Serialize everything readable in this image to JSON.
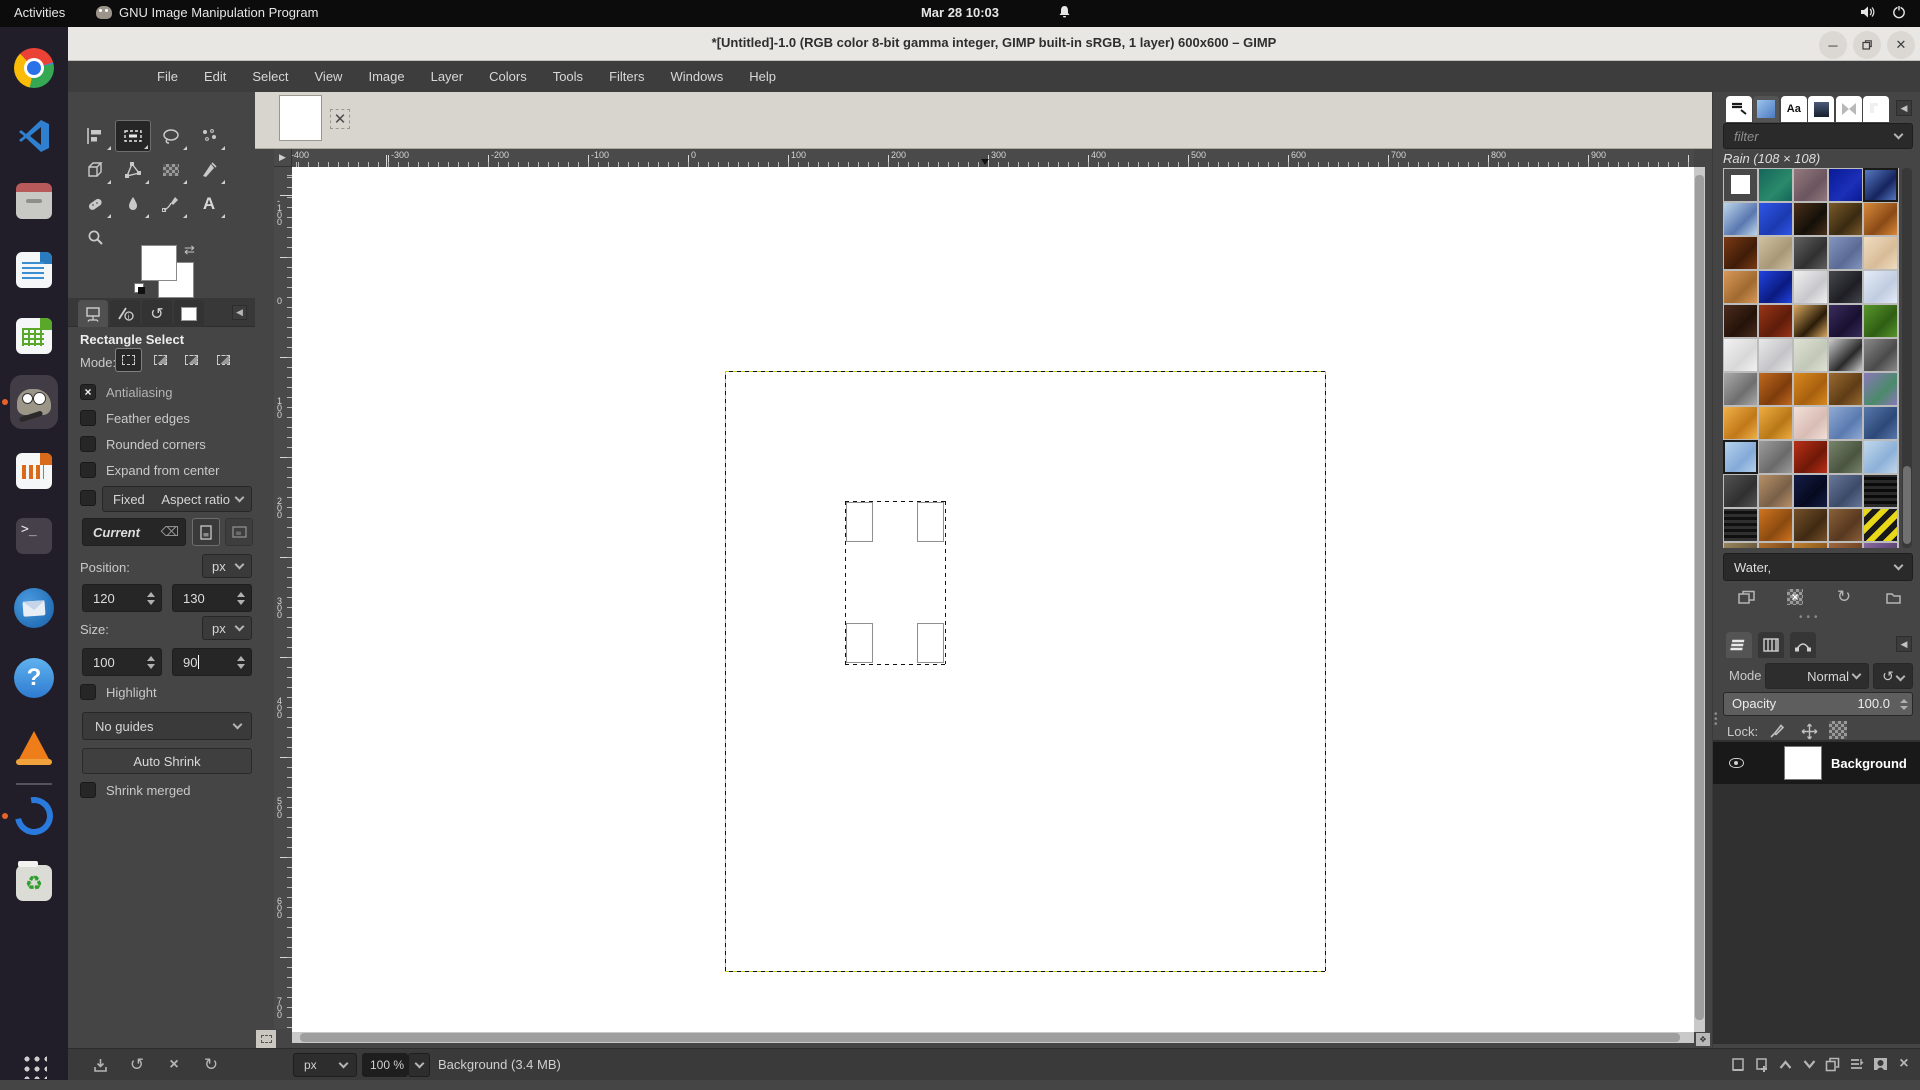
{
  "system_bar": {
    "activities": "Activities",
    "app_name": "GNU Image Manipulation Program",
    "clock": "Mar 28 10:03",
    "icons": [
      "bell-icon",
      "volume-icon",
      "power-icon"
    ]
  },
  "dock": {
    "items": [
      {
        "name": "chrome"
      },
      {
        "name": "vscode"
      },
      {
        "name": "files"
      },
      {
        "name": "writer"
      },
      {
        "name": "calc"
      },
      {
        "name": "gimp",
        "active": true,
        "running": true
      },
      {
        "name": "impress"
      },
      {
        "name": "terminal"
      },
      {
        "name": "thunderbird"
      },
      {
        "name": "help"
      },
      {
        "name": "vlc"
      },
      {
        "name": "divider"
      },
      {
        "name": "updater",
        "running": true
      },
      {
        "name": "trash"
      },
      {
        "name": "apps-grid"
      }
    ]
  },
  "window": {
    "title": "*[Untitled]-1.0 (RGB color 8-bit gamma integer, GIMP built-in sRGB, 1 layer) 600x600 – GIMP",
    "controls": [
      "minimize",
      "maximize",
      "close"
    ]
  },
  "menubar": {
    "items": [
      "File",
      "Edit",
      "Select",
      "View",
      "Image",
      "Layer",
      "Colors",
      "Tools",
      "Filters",
      "Windows",
      "Help"
    ]
  },
  "toolbox": {
    "tools": [
      {
        "name": "move"
      },
      {
        "name": "rectangle-select",
        "active": true
      },
      {
        "name": "free-select"
      },
      {
        "name": "fuzzy-select"
      },
      {
        "name": "unified-transform"
      },
      {
        "name": "handle-transform"
      },
      {
        "name": "gradient"
      },
      {
        "name": "airbrush"
      },
      {
        "name": "heal"
      },
      {
        "name": "blur"
      },
      {
        "name": "ink"
      },
      {
        "name": "text"
      },
      {
        "name": "zoom"
      }
    ]
  },
  "tool_options": {
    "tabs": [
      "tool-options",
      "device-status",
      "undo-history",
      "images"
    ],
    "title": "Rectangle Select",
    "mode_label": "Mode:",
    "mode_options": [
      "replace",
      "add",
      "subtract",
      "intersect"
    ],
    "antialiasing_label": "Antialiasing",
    "antialiasing_checked": true,
    "feather_label": "Feather edges",
    "rounded_label": "Rounded corners",
    "expand_label": "Expand from center",
    "fixed_label": "Fixed",
    "aspect_value": "Aspect ratio",
    "current_value": "Current",
    "position_label": "Position:",
    "position_unit": "px",
    "position_x": "120",
    "position_y": "130",
    "size_label": "Size:",
    "size_unit": "px",
    "size_width": "100",
    "size_height": "90",
    "highlight_label": "Highlight",
    "guides_value": "No guides",
    "auto_shrink_label": "Auto Shrink",
    "shrink_merged_label": "Shrink merged",
    "footer_buttons": [
      "save-tool-preset",
      "restore-tool-preset",
      "delete-tool-preset",
      "reset-tool-options"
    ]
  },
  "rulers": {
    "top_labels": [
      -400,
      -300,
      -200,
      -100,
      0,
      100,
      200,
      300,
      400,
      500,
      600,
      700,
      800,
      900
    ],
    "left_labels": [
      -100,
      0,
      100,
      200,
      300,
      400,
      500,
      600,
      700
    ],
    "marker_x": 297
  },
  "canvas": {
    "layer_boundary": {
      "x": 0,
      "y": 0,
      "width": 600,
      "height": 600
    },
    "selection": {
      "x": 120,
      "y": 130,
      "width": 100,
      "height": 163
    }
  },
  "patterns_panel": {
    "tabs": [
      "brushes",
      "patterns",
      "fonts",
      "document-history",
      "gradients",
      "buffers"
    ],
    "active_tab": "patterns",
    "filter_placeholder": "filter",
    "title": "Rain (108 × 108)",
    "tag_value": "Water,",
    "buttons": [
      "duplicate-pattern",
      "delete-pattern",
      "refresh-patterns",
      "open-pattern-folder"
    ],
    "selected_cells": [
      4,
      40
    ],
    "patterns": [
      [
        "#ffffff",
        "#ffffff",
        "p"
      ],
      [
        "#15655a",
        "#2a8a6a"
      ],
      [
        "#93797f",
        "#6b555e"
      ],
      [
        "#0a1a96",
        "#1b2fb8"
      ],
      [
        "#5a7ec8",
        "#16245e"
      ],
      [
        "#bcd6ea",
        "#5a77b0"
      ],
      [
        "#2f55e8",
        "#1b3ab0"
      ],
      [
        "#4a2f1a",
        "#141008"
      ],
      [
        "#7a5a2a",
        "#3a2a12"
      ],
      [
        "#d98a3a",
        "#8a4a16"
      ],
      [
        "#7a3a14",
        "#3f1c08"
      ],
      [
        "#cfc0a0",
        "#a89878"
      ],
      [
        "#606060",
        "#303030"
      ],
      [
        "#8496c0",
        "#5a6a94"
      ],
      [
        "#f0dcc0",
        "#d8bc98"
      ],
      [
        "#d89858",
        "#a06a30"
      ],
      [
        "#2244e0",
        "#0a1a80"
      ],
      [
        "#f0f0f0",
        "#c8c8cc"
      ],
      [
        "#46464e",
        "#1e1e24"
      ],
      [
        "#e4ecf8",
        "#c0cce0"
      ],
      [
        "#4a2c1e",
        "#241208"
      ],
      [
        "#9a3618",
        "#5e1c0a"
      ],
      [
        "#d8a860",
        "#2a1c08"
      ],
      [
        "#3a2c5e",
        "#181030"
      ],
      [
        "#58962c",
        "#2f5e14"
      ],
      [
        "#f2f2f2",
        "#d8d8d8"
      ],
      [
        "#e8e8e8",
        "#c4c4c8"
      ],
      [
        "#dee2d4",
        "#c2c8b8"
      ],
      [
        "#cccccc",
        "#2a2a2a"
      ],
      [
        "#8a8a8a",
        "#4a4a4a"
      ],
      [
        "#aaaaaa",
        "#6e6e6e"
      ],
      [
        "#c06a1e",
        "#7e3c0c"
      ],
      [
        "#d8891e",
        "#a8600e"
      ],
      [
        "#9a6a30",
        "#5e3c16"
      ],
      [
        "#8a78b8",
        "#4a8a6a"
      ],
      [
        "#f0b048",
        "#c07818"
      ],
      [
        "#f0ac40",
        "#b87818"
      ],
      [
        "#f2e0d8",
        "#d8bcb4"
      ],
      [
        "#90aad4",
        "#5a7ab0"
      ],
      [
        "#5878aa",
        "#2c4878"
      ],
      [
        "#b8d4ee",
        "#84aad8"
      ],
      [
        "#9c9c9c",
        "#6a6a6a"
      ],
      [
        "#b83018",
        "#701808"
      ],
      [
        "#78846a",
        "#4a5440"
      ],
      [
        "#c2d8ec",
        "#8cb0d8"
      ],
      [
        "#525252",
        "#303030"
      ],
      [
        "#b89068",
        "#786048"
      ],
      [
        "#141c44",
        "#060a20"
      ],
      [
        "#68789a",
        "#3c4a68"
      ],
      [
        "#2a2a2a",
        "#0a0a0a",
        "h"
      ],
      [
        "#303030",
        "#101010",
        "h"
      ],
      [
        "#d0741e",
        "#8a4a10"
      ],
      [
        "#74502a",
        "#402a12"
      ],
      [
        "#8a6038",
        "#573820"
      ],
      [
        "#e8d818",
        "#1a1a1a",
        "d"
      ],
      [
        "#98865e",
        "#6a5a3a"
      ],
      [
        "#b07030",
        "#7a4818"
      ],
      [
        "#c08030",
        "#8a5618"
      ],
      [
        "#a06840",
        "#6e4424"
      ],
      [
        "#8868a0",
        "#5a4470"
      ]
    ]
  },
  "layers_panel": {
    "tabs": [
      "layers",
      "channels",
      "paths"
    ],
    "active_tab": "layers",
    "mode_label": "Mode",
    "mode_value": "Normal",
    "opacity_label": "Opacity",
    "opacity_value": "100.0",
    "lock_label": "Lock:",
    "lock_icons": [
      "lock-pixels-brush-icon",
      "lock-position-icon",
      "lock-alpha-icon"
    ],
    "layer": {
      "name": "Background",
      "visible": true
    },
    "buttons": [
      "new-layer",
      "new-layer-group",
      "raise-layer",
      "lower-layer",
      "duplicate-layer",
      "merge-down",
      "add-mask",
      "delete-layer"
    ]
  },
  "status_bar": {
    "unit": "px",
    "zoom": "100 %",
    "message": "Background (3.4 MB)"
  }
}
